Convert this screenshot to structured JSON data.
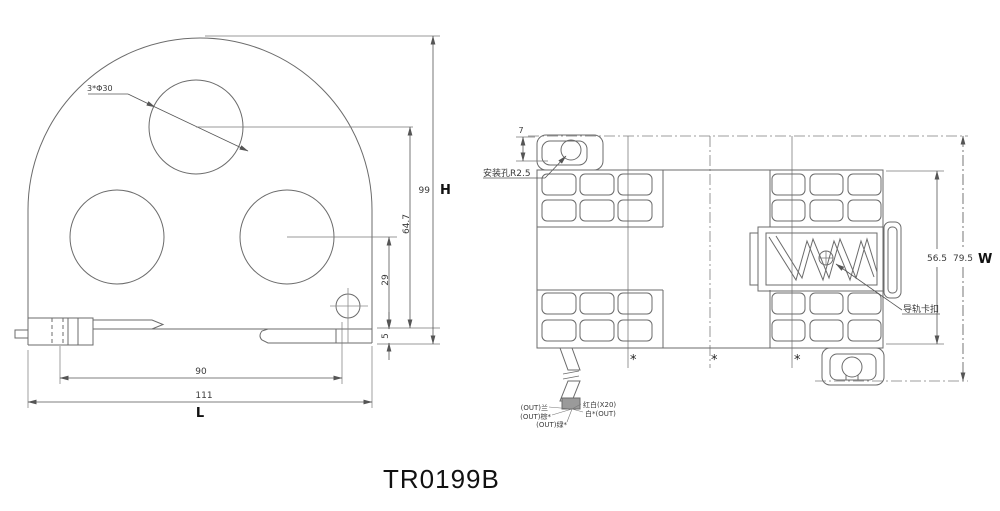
{
  "title": "TR0199B",
  "front_view": {
    "holes_label": "3*Φ30",
    "dim_height": "99",
    "dim_height_letter": "H",
    "dim_top_hole_center": "64.7",
    "dim_lower_hole_center": "29",
    "dim_foot": "5",
    "dim_inner_width": "90",
    "dim_width": "111",
    "dim_width_letter": "L"
  },
  "side_view": {
    "dim_top_offset": "7",
    "mount_hole_label": "安装孔R2.5",
    "rail_clip_label": "导轨卡扣",
    "dim_body_width": "56.5",
    "dim_overall_width": "79.5",
    "dim_width_letter": "W",
    "asterisks": [
      "*",
      "*",
      "*"
    ],
    "wire_labels": {
      "blue": "(OUT)兰",
      "brown": "(OUT)棕*",
      "green": "(OUT)绿*",
      "red_white": "红白(X20)",
      "white": "白*(OUT)"
    }
  }
}
